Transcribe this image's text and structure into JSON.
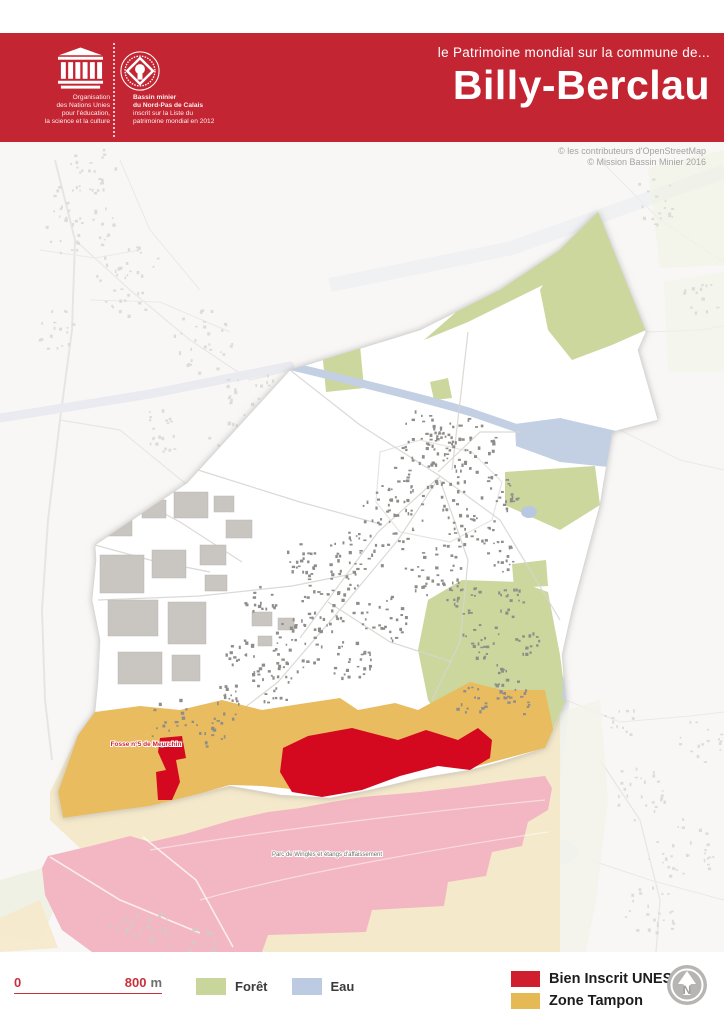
{
  "header": {
    "band_color": "#c32532",
    "unesco": {
      "org_lines": [
        "Organisation",
        "des Nations Unies",
        "pour l'éducation,",
        "la science et la culture"
      ]
    },
    "world_heritage": {
      "lines": [
        "Bassin minier",
        "du Nord-Pas de Calais",
        "inscrit sur la Liste du",
        "patrimoine mondial en 2012"
      ]
    },
    "subtitle": "le Patrimoine mondial sur la commune de...",
    "title": "Billy-Berclau"
  },
  "map": {
    "credit_line1": "© les contributeurs d'OpenStreetMap",
    "credit_line2": "© Mission Bassin Minier 2016",
    "label_fosse": "Fosse n°5 de Meurchin",
    "label_parc": "Parc de Wingles et étangs d'affaissement"
  },
  "scalebar": {
    "start": "0",
    "end": "800",
    "unit": "m"
  },
  "legend": {
    "foret": {
      "label": "Forêt",
      "color": "#c9d69b"
    },
    "eau": {
      "label": "Eau",
      "color": "#bccbe2"
    },
    "unesco": {
      "label": "Bien Inscrit UNESCO",
      "color": "#cf1f2e"
    },
    "tampon": {
      "label": "Zone Tampon",
      "color": "#e5ba55"
    }
  },
  "north": {
    "label": "N"
  },
  "colors": {
    "header_band": "#c32532",
    "header_fold": "#6d1118",
    "unesco_zone": "#d40920",
    "buffer_zone": "#e9bc5f",
    "unesco_zone_outside": "#f2b7c2",
    "buffer_zone_outside": "#f5e9cb",
    "forest": "#cbd79d",
    "water": "#c3cfe3"
  }
}
